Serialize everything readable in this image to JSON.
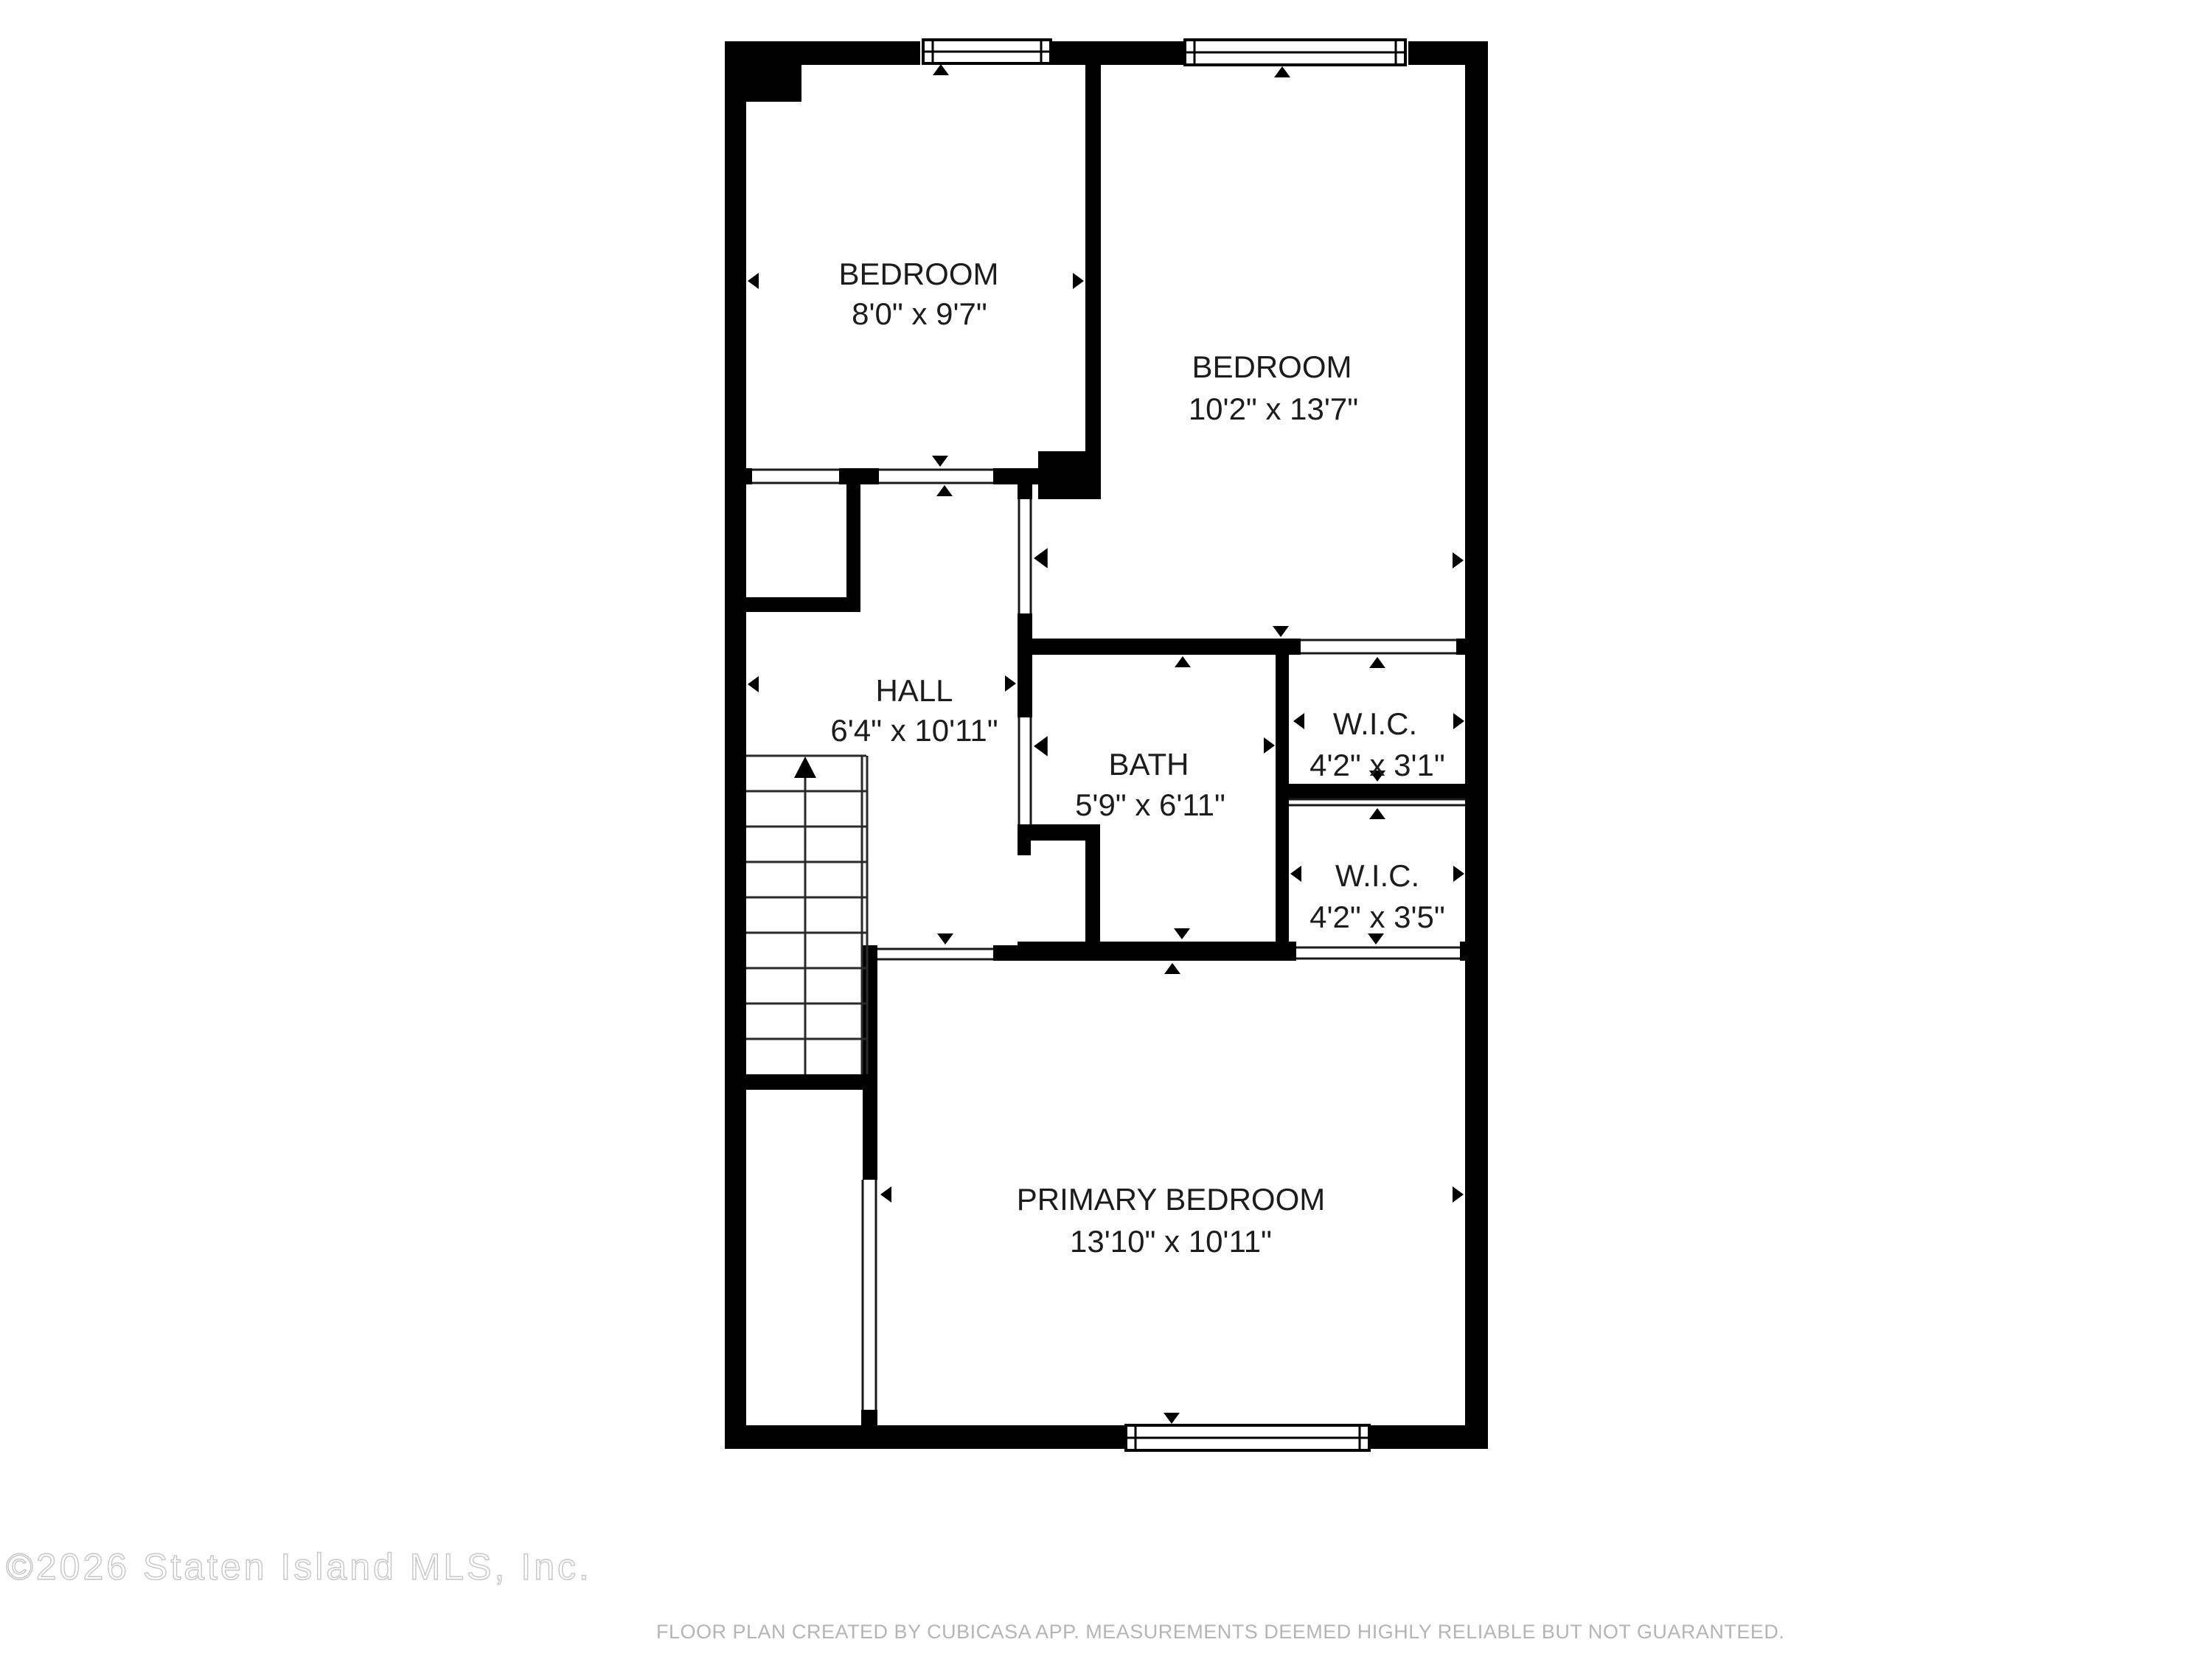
{
  "title": "Second floor plan",
  "rooms": {
    "bedroom_small": {
      "name": "BEDROOM",
      "dimensions": "8'0\" x 9'7\""
    },
    "bedroom_large": {
      "name": "BEDROOM",
      "dimensions": "10'2\" x 13'7\""
    },
    "hall": {
      "name": "HALL",
      "dimensions": "6'4\" x 10'11\""
    },
    "bath": {
      "name": "BATH",
      "dimensions": "5'9\" x 6'11\""
    },
    "wic_upper": {
      "name": "W.I.C.",
      "dimensions": "4'2\" x 3'1\""
    },
    "wic_lower": {
      "name": "W.I.C.",
      "dimensions": "4'2\" x 3'5\""
    },
    "primary_bedroom": {
      "name": "PRIMARY BEDROOM",
      "dimensions": "13'10\" x 10'11\""
    }
  },
  "icons": {
    "window": "double-line-window-glyph",
    "stairs_arrow": "stairs-up-arrow",
    "door_marker": "triangle-marker"
  },
  "footer": {
    "copyright": "©2026 Staten Island MLS, Inc.",
    "disclaimer": "FLOOR PLAN CREATED BY CUBICASA APP. MEASUREMENTS DEEMED HIGHLY RELIABLE BUT NOT GUARANTEED."
  },
  "colors": {
    "wall": "#000000",
    "label_text": "#1c1c1c",
    "copyright_outline": "#c6c6c6",
    "disclaimer_text": "#b5b5b5",
    "background": "#ffffff"
  }
}
